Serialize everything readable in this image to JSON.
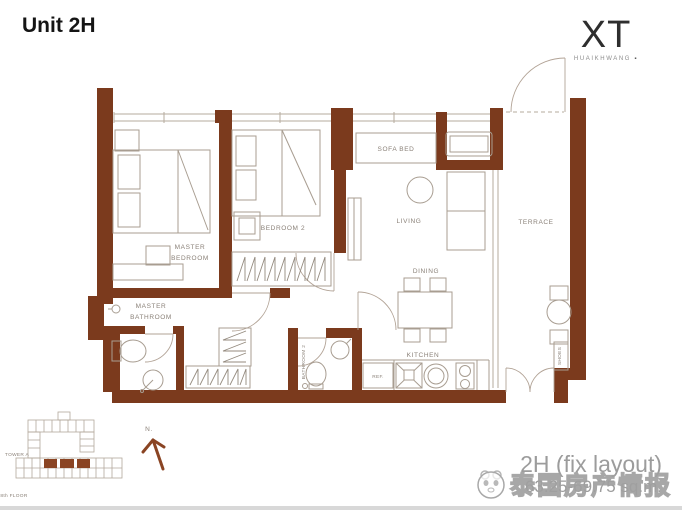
{
  "page": {
    "title": "Unit 2H"
  },
  "logo": {
    "brand": "XT",
    "sub": "HUAIKHWANG",
    "mark": "▪"
  },
  "plan": {
    "labels": {
      "master_bedroom_1": "MASTER",
      "master_bedroom_2": "BEDROOM",
      "bedroom2": "BEDROOM 2",
      "sofa_bed": "SOFA BED",
      "living": "LIVING",
      "terrace": "TERRACE",
      "dining": "DINING",
      "kitchen": "KITCHEN",
      "master_bathroom_1": "MASTER",
      "master_bathroom_2": "BATHROOM",
      "bathroom2": "BATHROOM 2",
      "ref": "REF.",
      "shoes": "SHOES"
    },
    "colors": {
      "wall": "#7b3a1d",
      "furniture_line": "#a89d91",
      "label_text": "#8a8178"
    }
  },
  "key_plan": {
    "tower": "TOWER A",
    "floor": "8th FLOOR",
    "compass": "N."
  },
  "footer": {
    "layout_name": "2H (fix layout)",
    "area": "63.25-69.75 sq.m."
  },
  "watermark": {
    "text": "泰国房产情报"
  }
}
